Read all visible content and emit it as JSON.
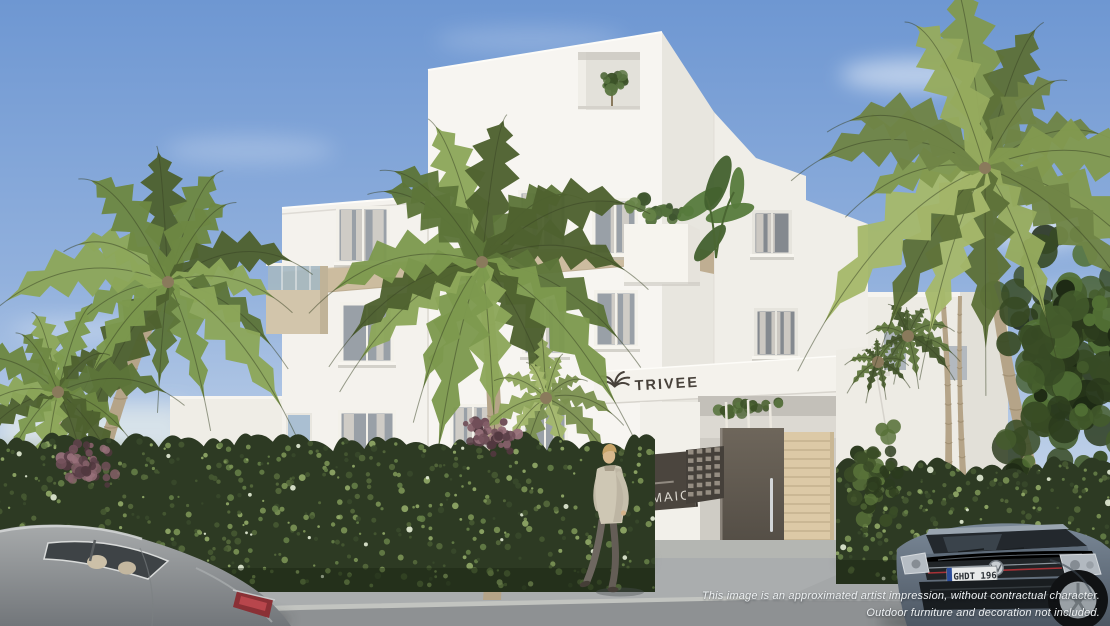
{
  "branding": {
    "logo_text": "TRIVEE",
    "sign_title": "MAIO",
    "sign_number": "12"
  },
  "vehicles": {
    "license_plate": "GHDT 196"
  },
  "disclaimer": {
    "line1": "This image is an approximated artist impression, without contractual character.",
    "line2": "Outdoor furniture and decoration not included."
  },
  "colors": {
    "sky_top": "#6e97d2",
    "sky_horizon": "#dfe8f2",
    "building_white": "#f6f4ef",
    "building_shade": "#e8e6df",
    "accent_beige": "#ccbc9f",
    "hedge_green": "#2d3a23",
    "palm_green": "#74894a",
    "door_brown": "#5f584e",
    "sign_panel": "#4a453e",
    "pavement_grey": "#a4a7a8"
  }
}
